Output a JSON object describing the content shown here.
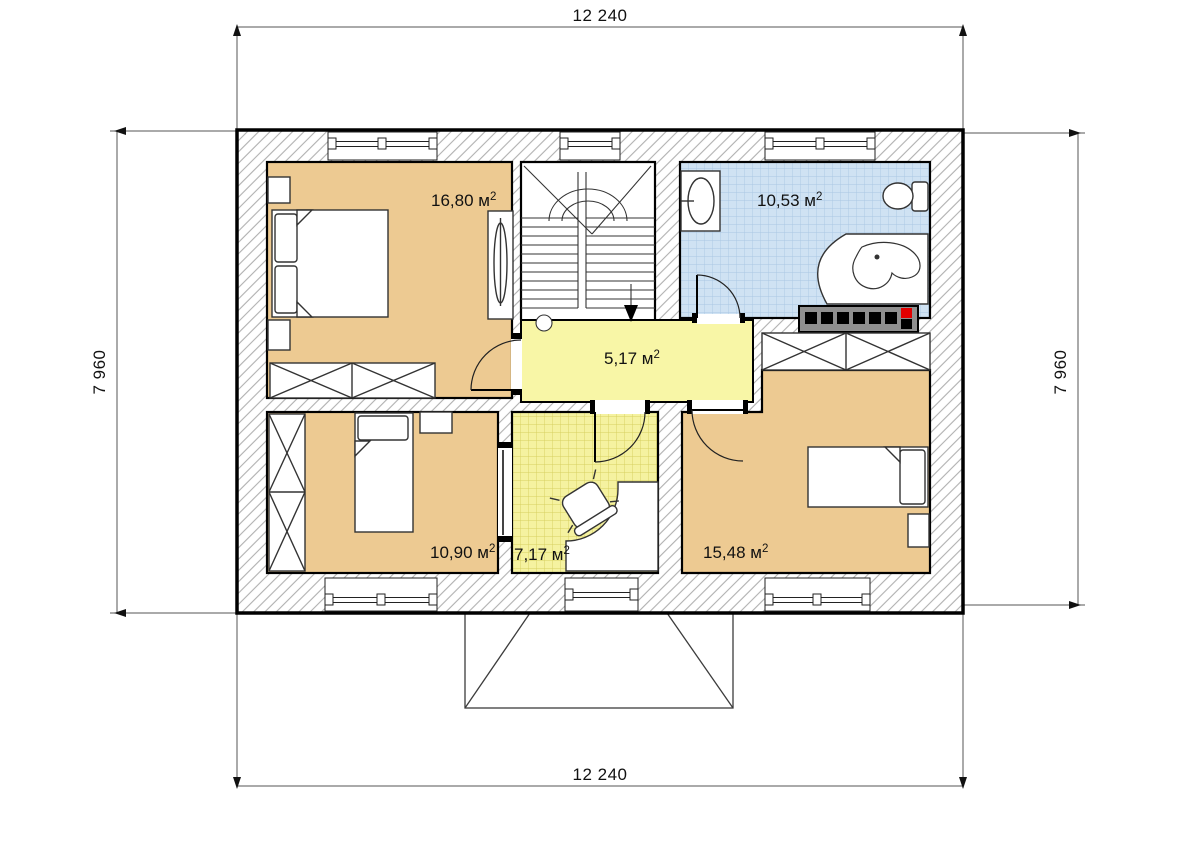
{
  "dimensions": {
    "top": "12 240",
    "bottom": "12 240",
    "left": "7 960",
    "right": "7 960"
  },
  "rooms": [
    {
      "id": "bedroom-1",
      "area": "16,80 м",
      "sup": "2"
    },
    {
      "id": "bathroom",
      "area": "10,53 м",
      "sup": "2"
    },
    {
      "id": "hall",
      "area": "5,17 м",
      "sup": "2"
    },
    {
      "id": "bedroom-2",
      "area": "10,90 м",
      "sup": "2"
    },
    {
      "id": "study",
      "area": "7,17 м",
      "sup": "2"
    },
    {
      "id": "bedroom-3",
      "area": "15,48 м",
      "sup": "2"
    }
  ],
  "colors": {
    "bedroom_fill": "#edca92",
    "hall_fill": "#f8f6a6",
    "bathroom_fill": "#cfe2f3",
    "study_fill": "#f5f2a0",
    "radiator_gray": "#8f8f8f",
    "radiator_red": "#e10000"
  }
}
